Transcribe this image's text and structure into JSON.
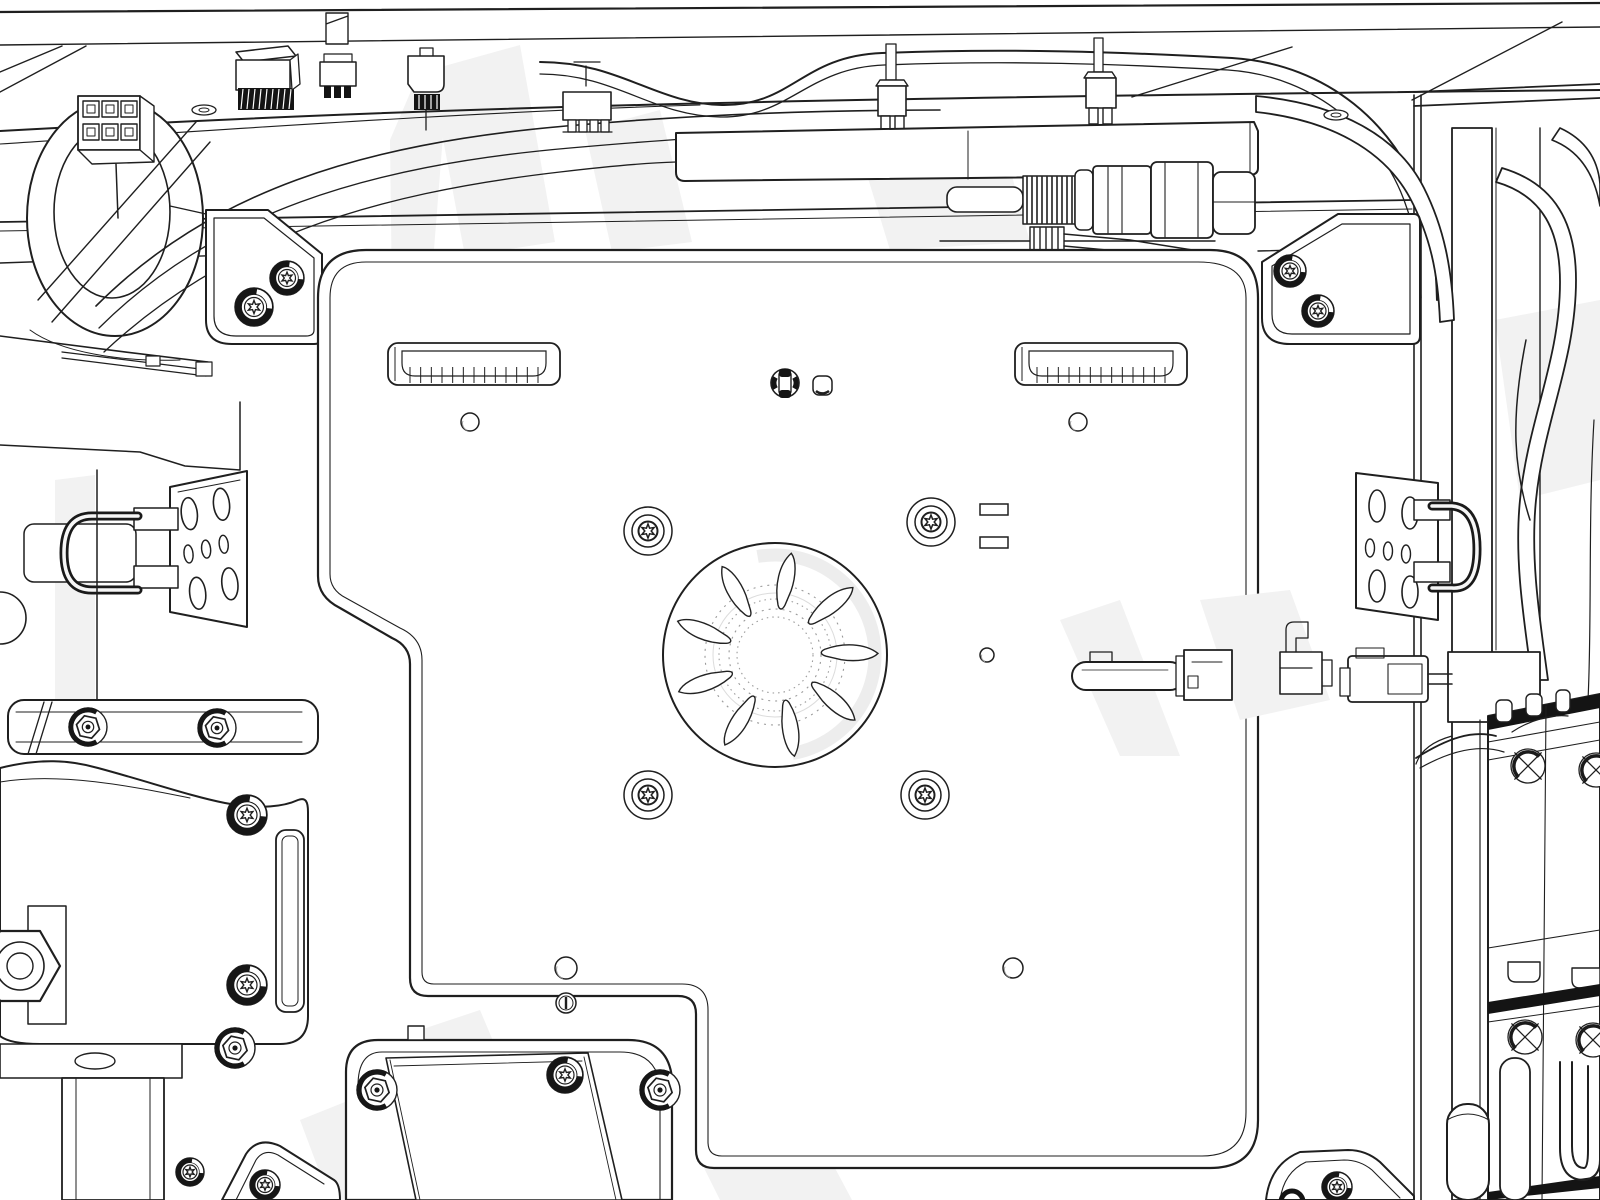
{
  "meta": {
    "description": "Monochrome engineering line illustration of a machine interior viewed from above: a large rounded mounting plate with a central fan impeller, four torx screw bosses, two ribbed vent slots, cable harnesses and wire connectors along the top frame, a threaded inline valve assembly, spring-wire latch plates on the left and right, hex flange bolts on the bottom-left motor mount, corner brackets, vertical frame columns with hoses, and relay modules with X-marked knockouts on the right."
  },
  "colors": {
    "line": "#1f1f1f",
    "dark": "#141414",
    "white": "#ffffff",
    "ghost": "#f2f2f2",
    "shade": "#ededed",
    "hub_dots": "#9a9a9a"
  },
  "impeller": {
    "cx": 775,
    "cy": 655,
    "r_outer": 112,
    "hub_radii": [
      70,
      56,
      46,
      38
    ],
    "blade_angles": [
      8,
      48,
      88,
      128,
      168,
      208,
      248,
      288,
      328
    ]
  },
  "vents": {
    "positions": [
      [
        388,
        343
      ],
      [
        1015,
        343
      ]
    ],
    "width": 172,
    "height": 42,
    "rib_count": 13
  },
  "fasteners": {
    "torx_bosses": [
      [
        648,
        531
      ],
      [
        931,
        522
      ],
      [
        648,
        795
      ],
      [
        925,
        795
      ]
    ],
    "torx_screws": [
      [
        287,
        278,
        17
      ],
      [
        254,
        307,
        19
      ],
      [
        1290,
        271,
        16
      ],
      [
        1318,
        311,
        16
      ],
      [
        247,
        815,
        20
      ],
      [
        247,
        985,
        20
      ],
      [
        565,
        1075,
        18
      ],
      [
        265,
        1185,
        15
      ],
      [
        1337,
        1187,
        15
      ],
      [
        190,
        1172,
        14
      ]
    ],
    "hex_screws": [
      [
        88,
        727,
        19
      ],
      [
        217,
        728,
        19
      ],
      [
        235,
        1048,
        20
      ],
      [
        377,
        1090,
        20
      ],
      [
        660,
        1090,
        20
      ]
    ],
    "holes": [
      [
        470,
        422,
        9
      ],
      [
        1078,
        422,
        9
      ],
      [
        987,
        655,
        7
      ],
      [
        566,
        968,
        11
      ],
      [
        1013,
        968,
        10
      ]
    ],
    "slot_screws": [
      [
        566,
        1003,
        10
      ]
    ],
    "square_holes": [
      [
        822,
        385
      ]
    ],
    "grommets": [
      [
        785,
        383
      ]
    ],
    "x_marks": [
      [
        1528,
        766,
        17
      ],
      [
        1596,
        770,
        17
      ],
      [
        1525,
        1037,
        17
      ],
      [
        1593,
        1040,
        17
      ]
    ],
    "flat_ovals": [
      [
        204,
        110
      ],
      [
        1336,
        115
      ]
    ],
    "rect_pads": [
      [
        980,
        504,
        28,
        11
      ],
      [
        980,
        537,
        28,
        11
      ]
    ]
  },
  "components": [
    "top-frame-rail",
    "cable-harness",
    "cable-duct",
    "inline-valve-assembly",
    "bleed-needle",
    "cable-ring",
    "molex-6pin-connector",
    "hatched-connector",
    "terminal-connectors",
    "latch-plate-left",
    "latch-plate-right",
    "mounting-plate",
    "fan-impeller",
    "vent-slots",
    "corner-brackets",
    "relay-modules",
    "motor-mount",
    "hex-flange-bolts",
    "torx-screws"
  ]
}
